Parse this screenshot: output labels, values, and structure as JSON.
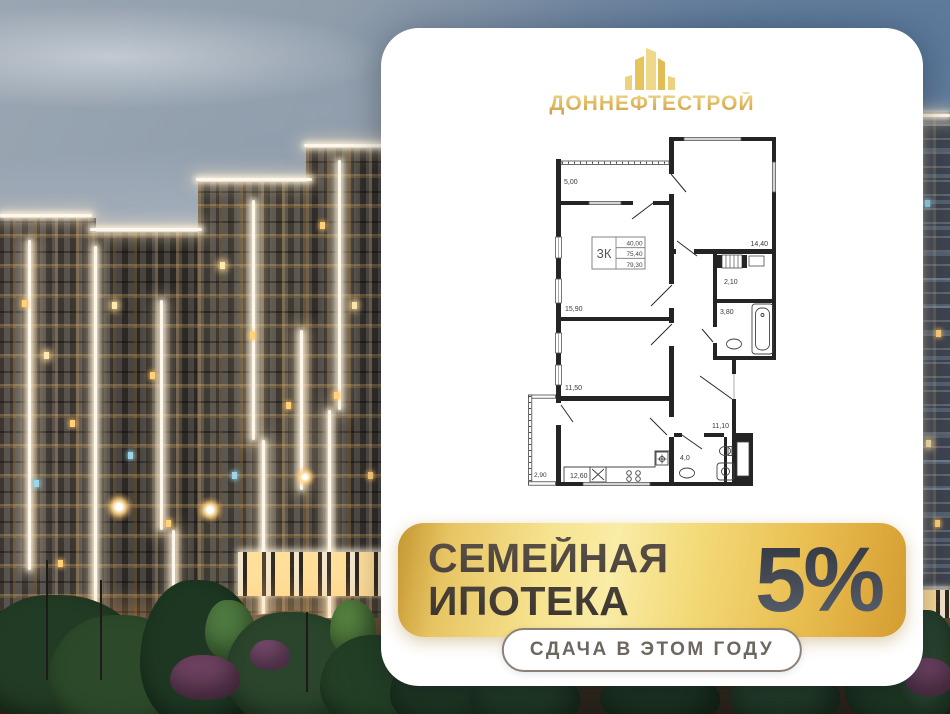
{
  "brand": {
    "name": "ДОННЕФТЕСТРОЙ",
    "gold": "#dcb253"
  },
  "floor_plan": {
    "unit_label": "3К",
    "areas": [
      "40,00",
      "75,40",
      "79,30"
    ],
    "rooms": [
      "5,00",
      "14,40",
      "15,90",
      "2,10",
      "3,80",
      "11,50",
      "11,10",
      "2,90",
      "12,60",
      "4,0"
    ]
  },
  "offer": {
    "line1": "СЕМЕЙНАЯ",
    "line2": "ИПОТЕКА",
    "rate": "5%",
    "badge": "СДАЧА В ЭТОМ ГОДУ",
    "banner_gold": "#f3d977",
    "title_color": "#453d36",
    "rate_color": "#434956"
  }
}
